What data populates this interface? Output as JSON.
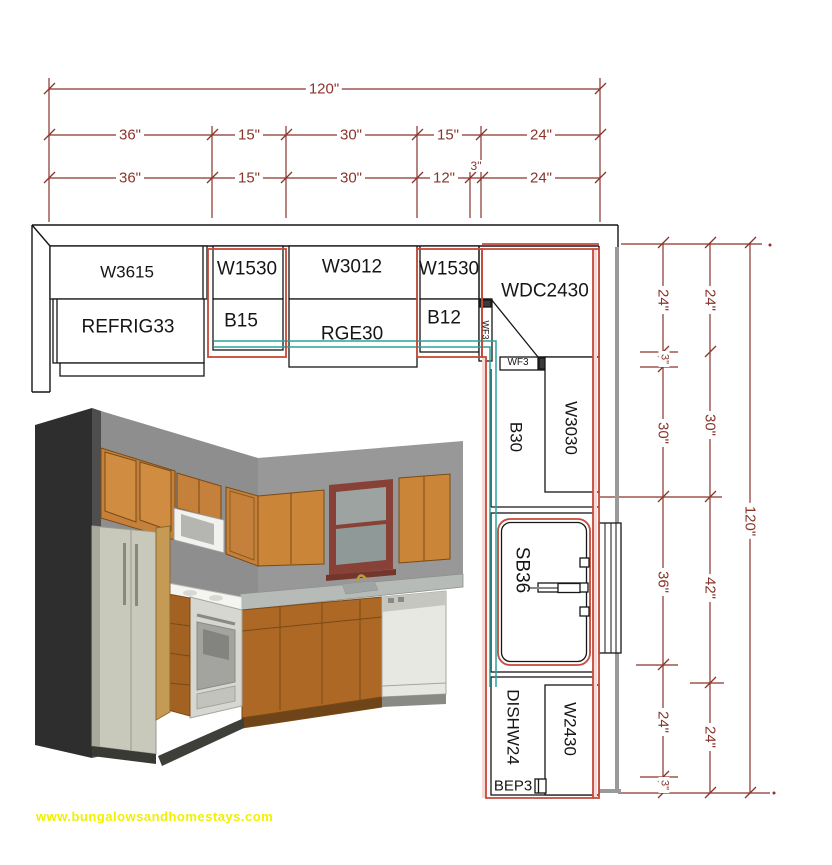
{
  "colors": {
    "line": "#161616",
    "dimension": "#8a342b",
    "counter_red": "#c6493a",
    "backsplash_teal": "#2aa39b",
    "wall_gray": "#9a9a9a",
    "watermark_yellow": "#f0f000",
    "wood_upper": "#c5813b",
    "wood_base": "#ad6826"
  },
  "plan": {
    "cabinets": {
      "wall_row": [
        "W3615",
        "W1530",
        "W3012",
        "W1530",
        "WDC2430"
      ],
      "base_row": [
        "REFRIG33",
        "B15",
        "RGE30",
        "B12"
      ],
      "fillers": [
        "WF3",
        "WF3"
      ],
      "right_run": [
        "B30",
        "W3030",
        "SB36",
        "DISHW24",
        "W2430",
        "BEP3"
      ]
    },
    "dimensions": {
      "top": {
        "overall": "120\"",
        "row2": [
          "36\"",
          "15\"",
          "30\"",
          "15\"",
          "24\""
        ],
        "row3": [
          "36\"",
          "15\"",
          "30\"",
          "12\"",
          "3\"",
          "24\""
        ]
      },
      "right": {
        "overall": "120\"",
        "inner": [
          "24\"",
          "3\"",
          "30\"",
          "36\"",
          "24\"",
          "3\""
        ],
        "middle": [
          "24\"",
          "30\"",
          "42\"",
          "24\""
        ]
      }
    }
  },
  "watermark": {
    "text": "www.bungalowsandhomestays.com",
    "color": "#f0f000"
  }
}
